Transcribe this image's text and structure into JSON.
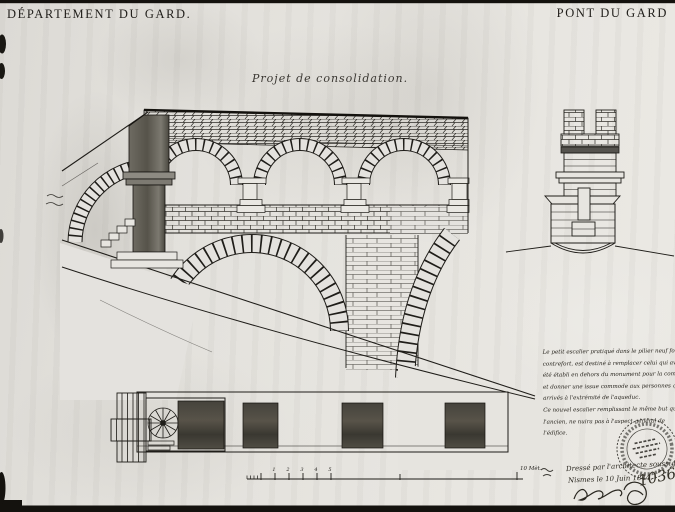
{
  "page": {
    "header_left": "DÉPARTEMENT DU GARD.",
    "header_right": "PONT DU GARD",
    "drawing_title": "Projet de consolidation.",
    "note_lines": [
      "Le petit escalier pratiqué dans le pilier neuf formant",
      "contrefort, est destiné à remplacer celui qui avait",
      "été établi en dehors du monument pour la commodité",
      "et donner une issue commode aux personnes qui sont",
      "arrivés à l'extrémité de l'aqueduc.",
      "Ce nouvel escalier remplissant le même but que",
      "l'ancien, ne nuira pas à l'aspect général de",
      "l'édifice."
    ],
    "credit_line": "Dressé par l'architecte soussigné",
    "date_line": "Nismes le 10 Juin 1844.",
    "inventory_number": "1036",
    "scale_bar": {
      "tick_labels": [
        "1",
        "2",
        "3",
        "4",
        "5"
      ],
      "end_label": "10 Mèt."
    },
    "colors": {
      "ink": "#1f1d19",
      "paper": "#e4e2de",
      "dark_wash": "#5c594f"
    }
  }
}
